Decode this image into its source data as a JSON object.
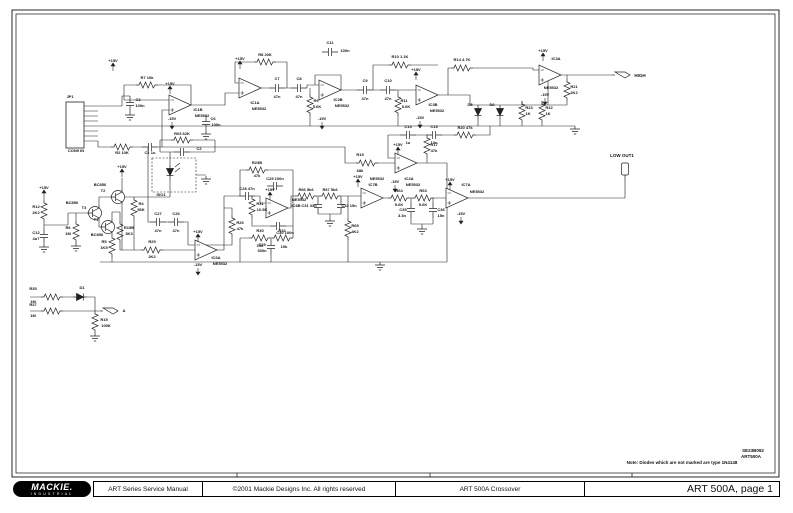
{
  "colors": {
    "ink": "#1a1a1a",
    "paper": "#ffffff"
  },
  "footer": {
    "logo_text": "MACKIE.",
    "logo_sub": "INDUSTRIAL",
    "cells": [
      "ART Series Service Manual",
      "©2001 Mackie Designs Inc. All rights reserved",
      "ART 500A Crossover"
    ],
    "page_label": "ART 500A, page 1"
  },
  "schematic": {
    "labels": [
      [
        "JP1",
        70,
        98
      ],
      [
        "CON9 IN",
        76,
        152
      ],
      [
        "+15V",
        113,
        62
      ],
      [
        "C3",
        138,
        101
      ],
      [
        "100n",
        140,
        107
      ],
      [
        "R2 10K",
        122,
        154
      ],
      [
        "C1 1u",
        150,
        154
      ],
      [
        "R7 10k",
        147,
        79
      ],
      [
        "+15V",
        170,
        85
      ],
      [
        "IC1B",
        198,
        111
      ],
      [
        "NE5532",
        202,
        117
      ],
      [
        "-15V",
        172,
        120
      ],
      [
        "C6",
        213,
        120
      ],
      [
        "100n",
        216,
        126
      ],
      [
        "R03 62K",
        182,
        135
      ],
      [
        "C2",
        199,
        150
      ],
      [
        "ISO1",
        161,
        196
      ],
      [
        "+15V",
        240,
        60
      ],
      [
        "IC1A",
        255,
        104
      ],
      [
        "NE5532",
        259,
        110
      ],
      [
        "R8 20K",
        265,
        56
      ],
      [
        "C7",
        277,
        80
      ],
      [
        "47n",
        277,
        98
      ],
      [
        "C8",
        299,
        80
      ],
      [
        "47n",
        299,
        98
      ],
      [
        "R9",
        316,
        102
      ],
      [
        "5.6K",
        317,
        108
      ],
      [
        "C11",
        330,
        44
      ],
      [
        "100n",
        345,
        52
      ],
      [
        "IC2B",
        338,
        101
      ],
      [
        "NE5532",
        342,
        107
      ],
      [
        "-15V",
        322,
        120
      ],
      [
        "C9",
        365,
        82
      ],
      [
        "47n",
        365,
        100
      ],
      [
        "C10",
        388,
        82
      ],
      [
        "47n",
        388,
        100
      ],
      [
        "R10 1.1K",
        400,
        58
      ],
      [
        "R11",
        404,
        102
      ],
      [
        "5.6K",
        406,
        108
      ],
      [
        "R14 4.7K",
        462,
        61
      ],
      [
        "+15V",
        416,
        71
      ],
      [
        "IC3B",
        433,
        106
      ],
      [
        "NE5532",
        437,
        112
      ],
      [
        "-15V",
        420,
        119
      ],
      [
        "+15V",
        543,
        52
      ],
      [
        "IC3A",
        556,
        60
      ],
      [
        "NE5532",
        551,
        89
      ],
      [
        "-15V",
        545,
        96
      ],
      [
        "R21",
        574,
        88
      ],
      [
        "2K2",
        574,
        94
      ],
      [
        "HIGH",
        640,
        77,
        4.5
      ],
      [
        "D5",
        470,
        106
      ],
      [
        "D6",
        492,
        106
      ],
      [
        "R23",
        529,
        109
      ],
      [
        "1K",
        528,
        115
      ],
      [
        "R22",
        549,
        109
      ],
      [
        "1K",
        548,
        115
      ],
      [
        "C14",
        408,
        128
      ],
      [
        "1u",
        408,
        144
      ],
      [
        "C13",
        434,
        128
      ],
      [
        "10n",
        434,
        144
      ],
      [
        "R20 47k",
        465,
        129
      ],
      [
        "R19",
        360,
        156
      ],
      [
        "68k",
        360,
        172
      ],
      [
        "+15V",
        398,
        146
      ],
      [
        "R17",
        434,
        146
      ],
      [
        "47k",
        434,
        152
      ],
      [
        "IC2A",
        409,
        180
      ],
      [
        "NE5532",
        413,
        186
      ],
      [
        "-15V",
        395,
        183
      ],
      [
        "LOW OUT1",
        622,
        157,
        4.5
      ],
      [
        "+15V",
        122,
        168
      ],
      [
        "BC856",
        100,
        186
      ],
      [
        "T2",
        103,
        192
      ],
      [
        "BC856",
        72,
        204
      ],
      [
        "T3",
        84,
        209
      ],
      [
        "T1",
        96,
        221
      ],
      [
        "BC856",
        97,
        236
      ],
      [
        "R4",
        141,
        205
      ],
      [
        "56K",
        141,
        211
      ],
      [
        "R6",
        68,
        229
      ],
      [
        "1M",
        68,
        235
      ],
      [
        "R5",
        104,
        243
      ],
      [
        "1K5",
        104,
        249
      ],
      [
        "R15B",
        129,
        229
      ],
      [
        "3K3",
        129,
        235
      ],
      [
        "+15V",
        44,
        189
      ],
      [
        "R12",
        36,
        208
      ],
      [
        "2K2",
        36,
        214
      ],
      [
        "C12",
        36,
        234
      ],
      [
        "4u7",
        36,
        240
      ],
      [
        "R29",
        152,
        243
      ],
      [
        "2K2",
        152,
        258
      ],
      [
        "C27",
        158,
        215
      ],
      [
        "47n",
        158,
        232
      ],
      [
        "C26",
        176,
        215
      ],
      [
        "47n",
        176,
        232
      ],
      [
        "R26",
        240,
        224
      ],
      [
        "47k",
        240,
        230
      ],
      [
        "+15V",
        198,
        233
      ],
      [
        "IC6A",
        216,
        259
      ],
      [
        "NE5532",
        220,
        265
      ],
      [
        "-15V",
        198,
        266
      ],
      [
        "R23B",
        257,
        164
      ],
      [
        "47k",
        257,
        177
      ],
      [
        "C28 47n",
        247,
        190
      ],
      [
        "R31",
        260,
        205
      ],
      [
        "10.5K",
        262,
        211
      ],
      [
        "C25 100n",
        275,
        180
      ],
      [
        "+15V",
        270,
        191
      ],
      [
        "NE5532",
        299,
        201
      ],
      [
        "IC6B",
        296,
        207
      ],
      [
        "C30 100n",
        285,
        234
      ],
      [
        "R30",
        260,
        232
      ],
      [
        "10k",
        260,
        247
      ],
      [
        "R32",
        282,
        232
      ],
      [
        "10k",
        284,
        248
      ],
      [
        "C29",
        262,
        246
      ],
      [
        "330n",
        262,
        252
      ],
      [
        "R65",
        355,
        227
      ],
      [
        "4K2",
        355,
        233
      ],
      [
        "R66 5k6",
        306,
        191
      ],
      [
        "R67 5k6",
        330,
        191
      ],
      [
        "C31 33n",
        309,
        207
      ],
      [
        "C32 15n",
        349,
        207
      ],
      [
        "+15V",
        358,
        178
      ],
      [
        "NE5532",
        377,
        180
      ],
      [
        "IC7B",
        373,
        186
      ],
      [
        "R64",
        399,
        192
      ],
      [
        "5.6K",
        399,
        206
      ],
      [
        "R63",
        423,
        192
      ],
      [
        "5.6K",
        423,
        206
      ],
      [
        "C35",
        403,
        211
      ],
      [
        "3.3n",
        402,
        217
      ],
      [
        "C36",
        441,
        211
      ],
      [
        "15n",
        441,
        217
      ],
      [
        "+15V",
        450,
        181
      ],
      [
        "IC7A",
        466,
        186
      ],
      [
        "NE5532",
        477,
        193
      ],
      [
        "-15V",
        461,
        215
      ],
      [
        "R35",
        33,
        290
      ],
      [
        "1M",
        33,
        303
      ],
      [
        "D1",
        82,
        289
      ],
      [
        "R37",
        33,
        306
      ],
      [
        "1M",
        33,
        317
      ],
      [
        "R15",
        104,
        321
      ],
      [
        "100K",
        106,
        327
      ],
      [
        "A",
        124,
        312
      ],
      [
        "Note: Diodes which are not marked are type 1N4148",
        682,
        464,
        4.5
      ],
      [
        "SE23B092",
        753,
        452,
        4.5
      ],
      [
        "ART500A",
        751,
        458,
        4.5
      ]
    ]
  }
}
